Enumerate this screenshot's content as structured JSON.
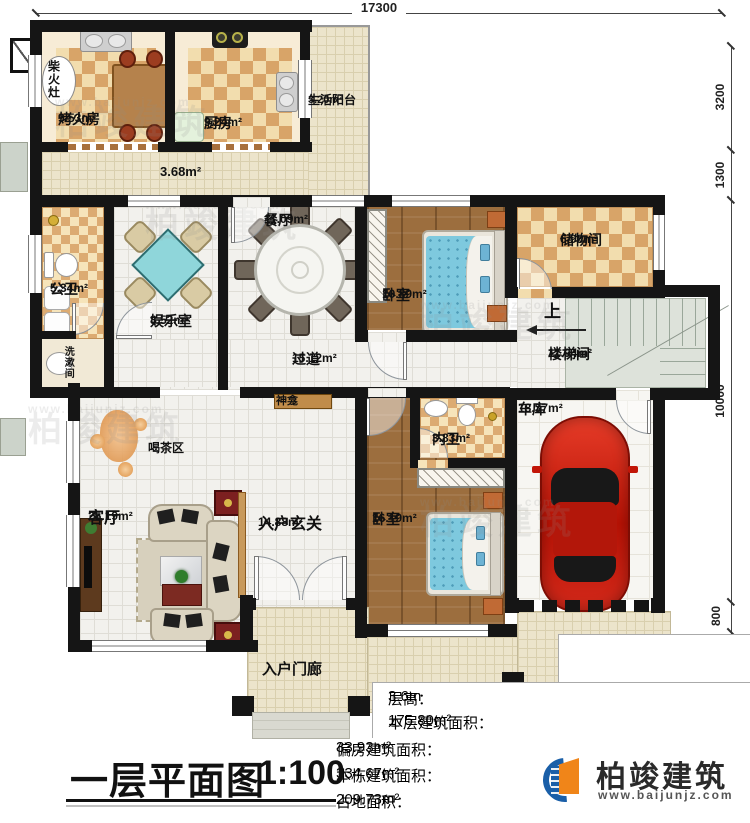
{
  "title": {
    "name": "一层平面图",
    "scale": "1:100"
  },
  "brand": {
    "name": "柏竣建筑",
    "url": "www.baijunjz.com"
  },
  "watermark": {
    "name": "柏竣建筑",
    "url": "www.baijunjz.com"
  },
  "dimensions": {
    "top": "17300",
    "right": [
      "3200",
      "1300",
      "10000",
      "800",
      "1200",
      "600"
    ]
  },
  "rooms": {
    "kaohuofang": {
      "name": "烤火房",
      "area": "9.53m²"
    },
    "chufang": {
      "name": "厨房",
      "area": "9.24m²"
    },
    "shenghuoyangtai": {
      "name": "生活阳台",
      "area": "3.20m²"
    },
    "annex_corridor": {
      "area": "3.68m²"
    },
    "chaihuozao": {
      "name": "柴火灶"
    },
    "gongwei": {
      "name": "公卫",
      "area": "5.34m²"
    },
    "xishujian": {
      "name": "洗漱间"
    },
    "yuleshi": {
      "name": "娱乐室",
      "area": "8.52m²"
    },
    "canting": {
      "name": "餐厅",
      "area": "11.09m²"
    },
    "woshi1": {
      "name": "卧室",
      "area": "10.89m²"
    },
    "chuwujian": {
      "name": "储物间",
      "area": "6.98m²"
    },
    "loutijian": {
      "name": "楼梯间",
      "area": "11.94m²"
    },
    "shang": {
      "name": "上"
    },
    "guodao": {
      "name": "过道",
      "area": "15.12m²"
    },
    "shenkan": {
      "name": "神龛"
    },
    "hechaqu": {
      "name": "喝茶区"
    },
    "keting": {
      "name": "客厅",
      "area": "25.19m²"
    },
    "ruhuxuanguan": {
      "name": "入户玄关",
      "area": "14.88m²"
    },
    "neiwei": {
      "name": "内卫",
      "area": "3.83m²"
    },
    "cheku": {
      "name": "车库",
      "area": "18.37m²"
    },
    "woshi2": {
      "name": "卧室",
      "area": "16.19m²"
    },
    "ruhumenlang": {
      "name": "入户门廊"
    }
  },
  "info": {
    "floor_height": {
      "label": "层高：",
      "value": "3.6m"
    },
    "floor_area": {
      "label": "本层建筑面积：",
      "value": "175.80m²"
    },
    "annex_area": {
      "label": "偏房建筑面积：",
      "value": "33.93m²"
    },
    "building_area": {
      "label": "本栋建筑面积：",
      "value": "334.67m²"
    },
    "land_area": {
      "label": "占地面积：",
      "value": "209.73m²"
    }
  },
  "colors": {
    "wall": "#151515",
    "checker_dark": "#d8a468",
    "checker_light": "#f2ddae",
    "wood": "#9c6e3e",
    "bed_teal": "#7ec9de",
    "car_red": "#c61a0c",
    "brand_blue": "#1a5fa8",
    "brand_orange": "#f08519"
  }
}
